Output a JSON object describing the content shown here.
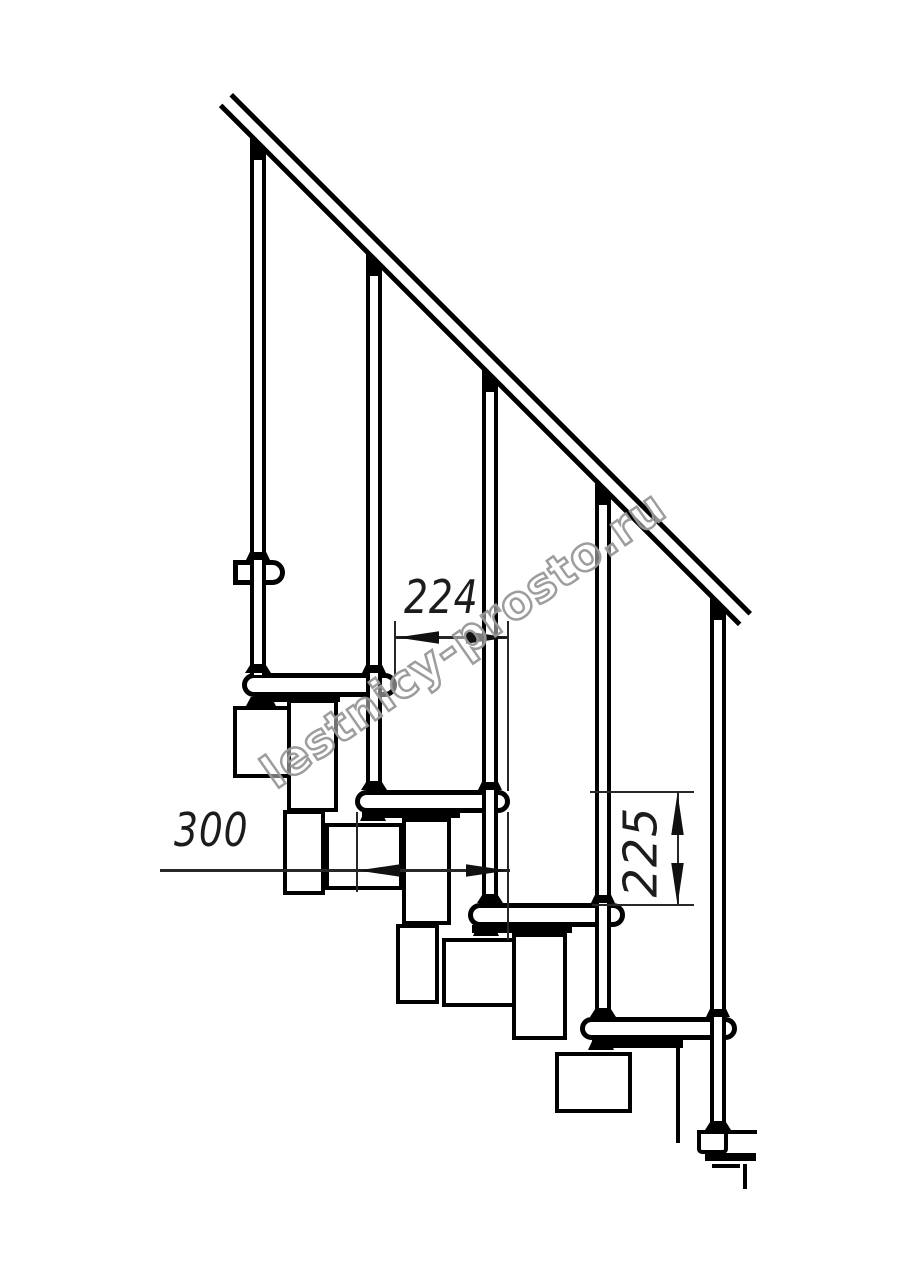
{
  "drawing": {
    "dimensions": {
      "d224": "224",
      "d300": "300",
      "d225": "225"
    },
    "watermark": {
      "text": "lestnicy-prosto.ru"
    },
    "colors": {
      "line": "#000000",
      "dimension_line": "#272727",
      "watermark_outline": "#989898",
      "background": "#ffffff"
    }
  }
}
